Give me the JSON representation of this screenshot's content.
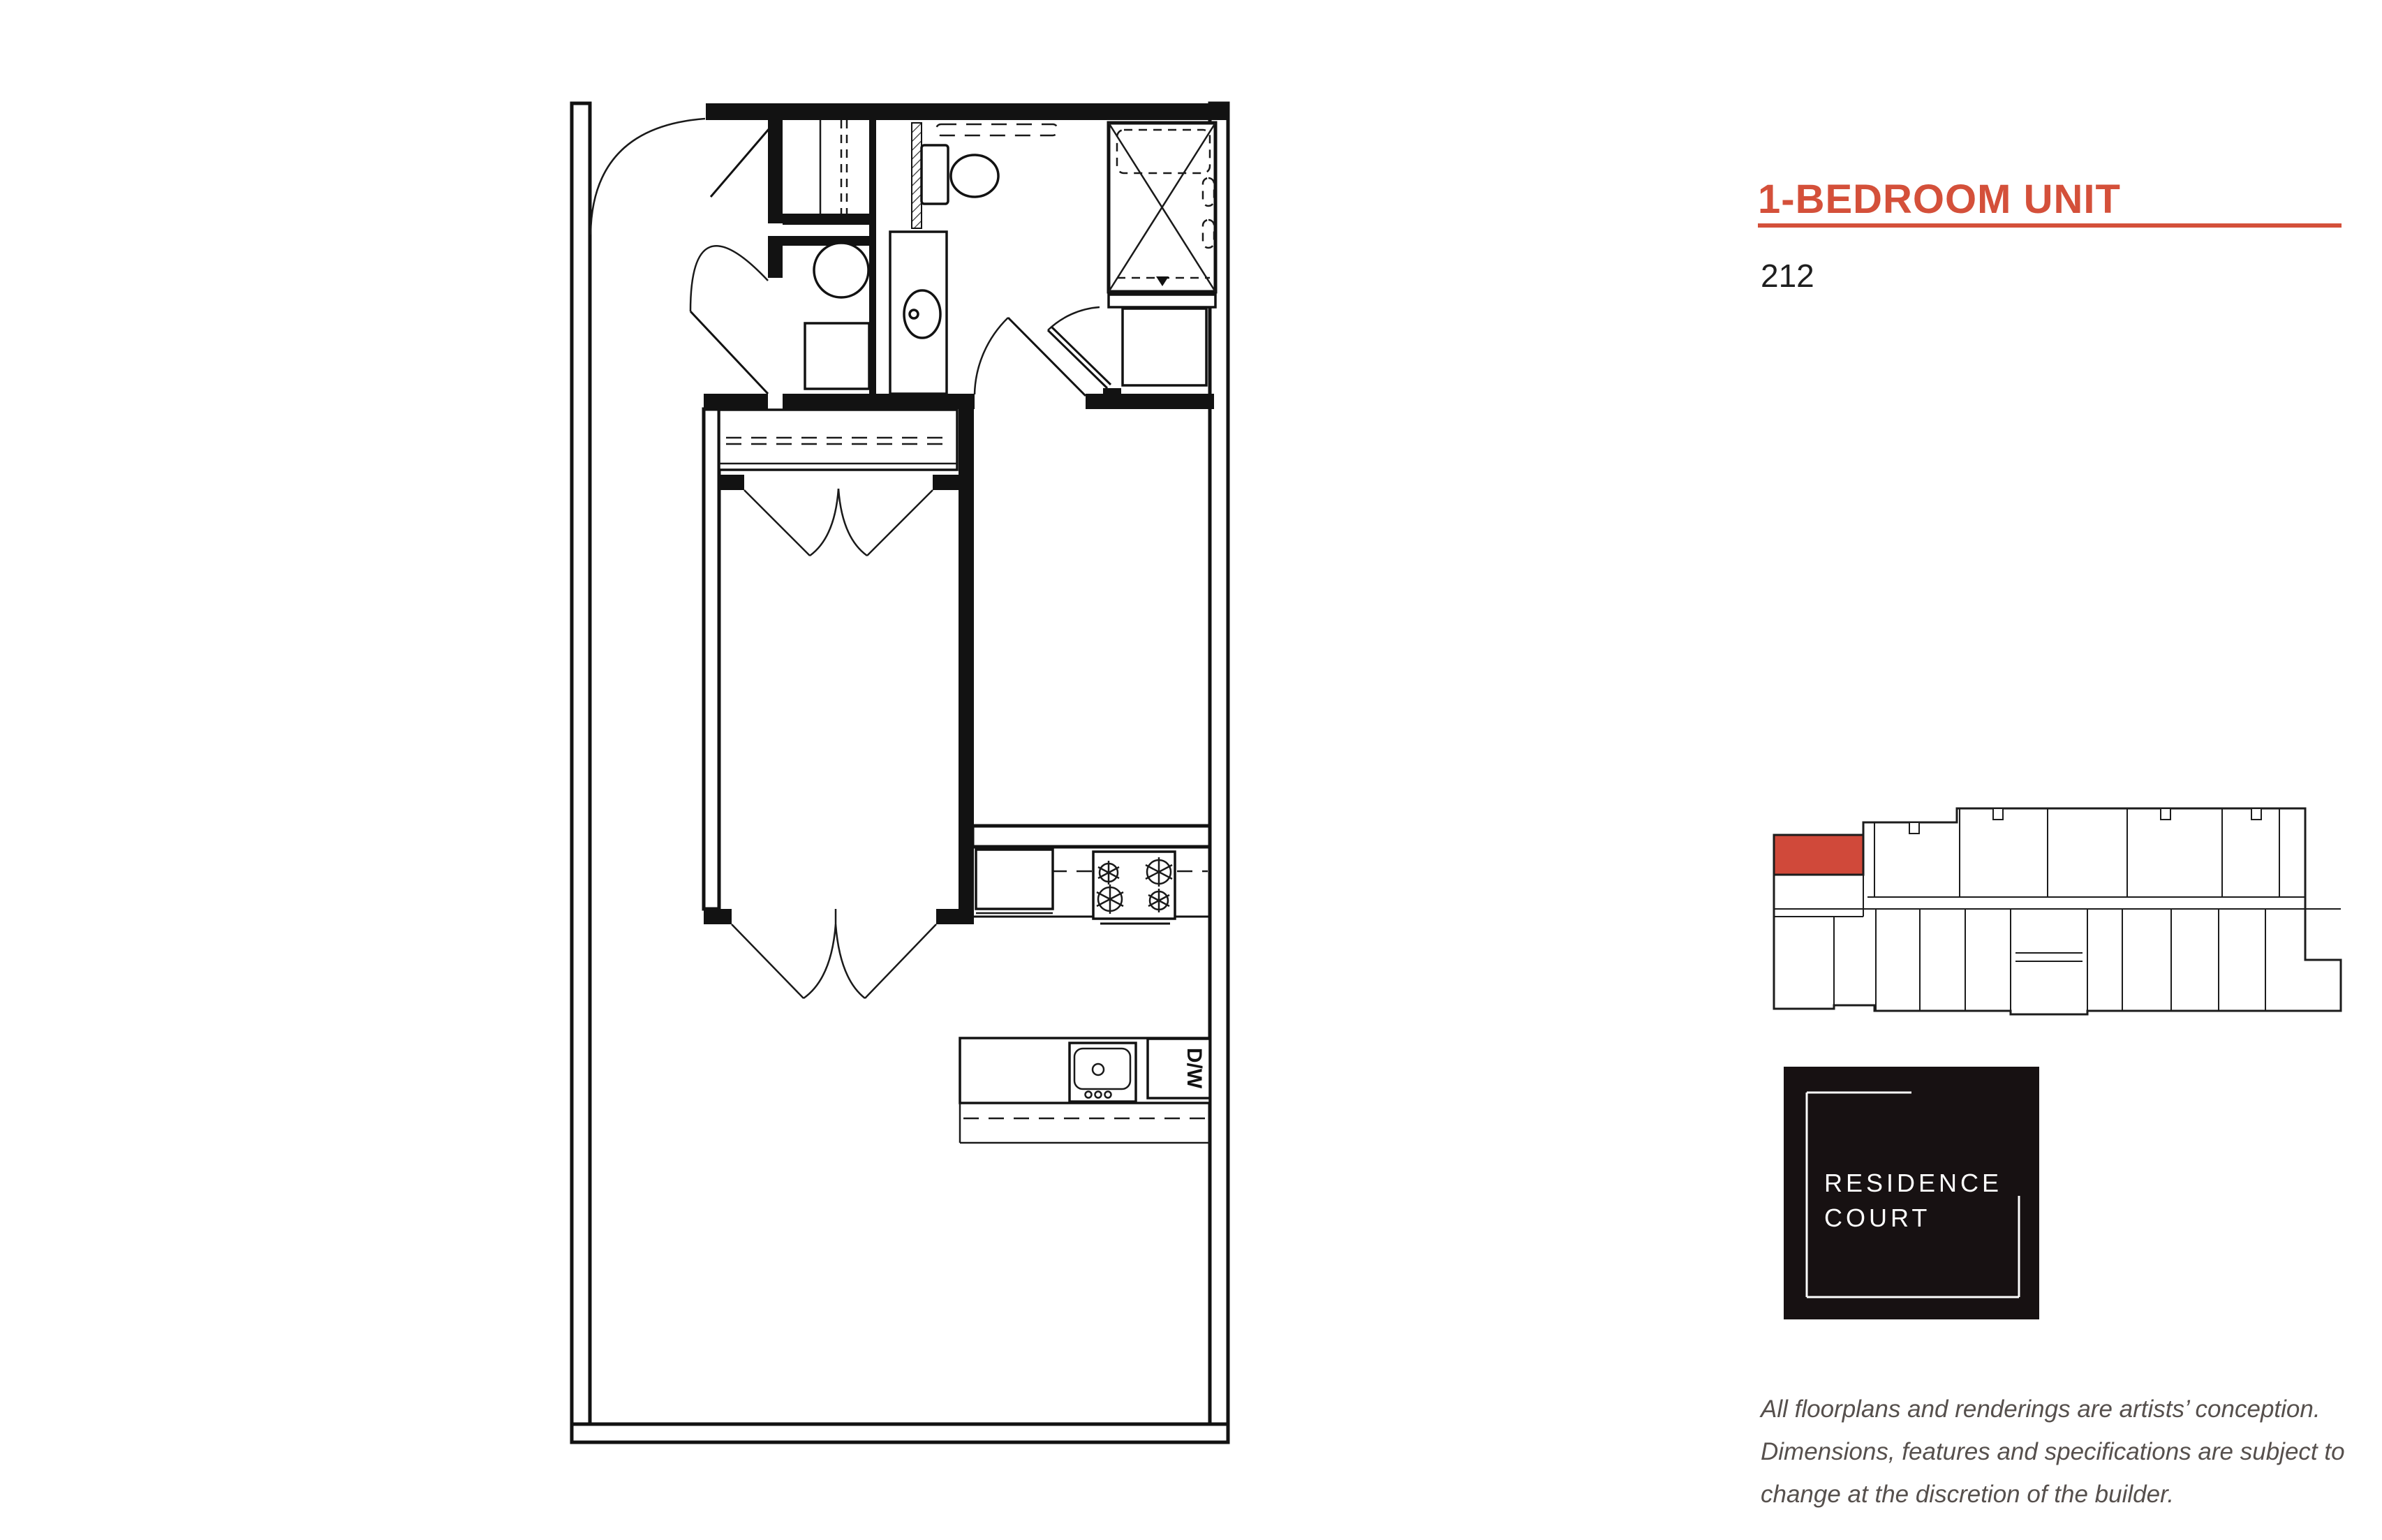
{
  "unit": {
    "title": "1-BEDROOM UNIT",
    "number": "212"
  },
  "colors": {
    "accent_red": "#d4503a",
    "locator_highlight": "#d0493a",
    "logo_background": "#171112",
    "plan_line": "#121212",
    "disclaimer_gray": "#56504d"
  },
  "floorplan": {
    "dishwasher_label": "D/W"
  },
  "logo": {
    "line1": "RESIDENCE",
    "line2": "COURT"
  },
  "disclaimer": {
    "lines": [
      "All floorplans and renderings are artists’ conception.",
      "Dimensions, features and specifications are subject to",
      "change at the discretion of the builder."
    ]
  }
}
